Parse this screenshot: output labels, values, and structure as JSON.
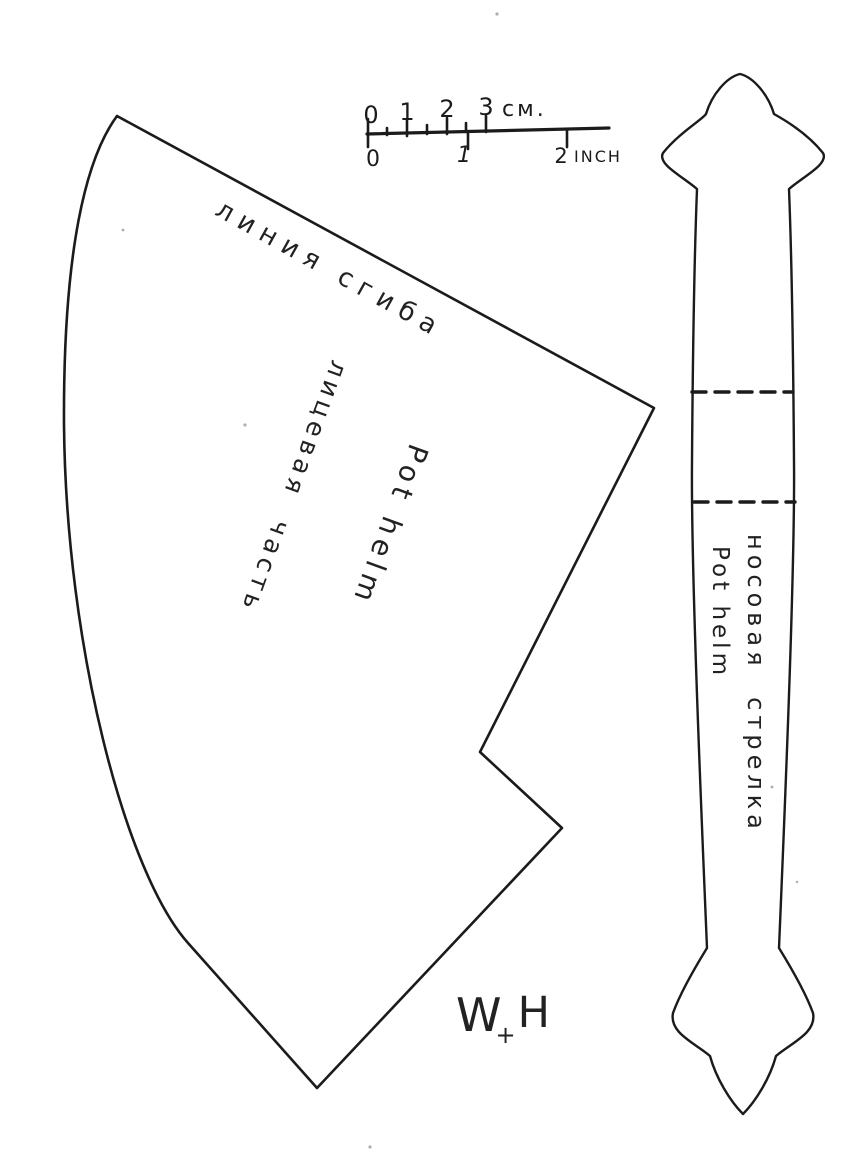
{
  "document": {
    "ink_color": "#1b1b1b",
    "paper_color": "#ffffff"
  },
  "ruler": {
    "cm_labels": [
      "0",
      "1",
      "2",
      "3"
    ],
    "cm_unit": "см.",
    "inch_labels": [
      "0",
      "1",
      "2"
    ],
    "inch_unit": "INCH"
  },
  "face_piece": {
    "fold_line_label": "линия сгиба",
    "name_latin": "Pot helm",
    "name_cyrillic": "лицевая часть"
  },
  "nasal_bar": {
    "name_cyrillic": "носовая стрелка",
    "name_latin": "Pot helm"
  },
  "signature": {
    "first": "W",
    "separator": "+",
    "second": "H"
  }
}
